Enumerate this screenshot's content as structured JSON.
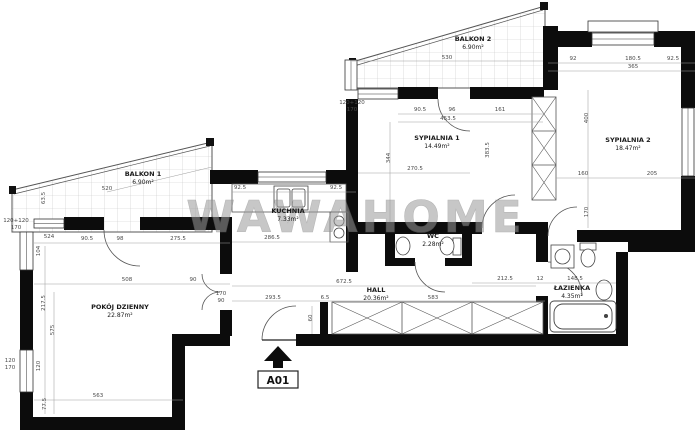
{
  "watermark": "WAWAHOME",
  "entrance": {
    "label": "A01"
  },
  "rooms": [
    {
      "id": "balkon-1",
      "name": "BALKON 1",
      "area": "6.90m²",
      "x": 143,
      "y": 176
    },
    {
      "id": "balkon-2",
      "name": "BALKON 2",
      "area": "6.90m²",
      "x": 473,
      "y": 41
    },
    {
      "id": "sypialnia-1",
      "name": "SYPIALNIA 1",
      "area": "14.49m²",
      "x": 437,
      "y": 140
    },
    {
      "id": "sypialnia-2",
      "name": "SYPIALNIA 2",
      "area": "18.47m²",
      "x": 628,
      "y": 142
    },
    {
      "id": "kuchnia",
      "name": "KUCHNIA",
      "area": "7.33m²",
      "x": 288,
      "y": 213
    },
    {
      "id": "wc",
      "name": "WC",
      "area": "2.28m²",
      "x": 433,
      "y": 238
    },
    {
      "id": "hall",
      "name": "HALL",
      "area": "20.36m²",
      "x": 376,
      "y": 292
    },
    {
      "id": "lazienka",
      "name": "ŁAZIENKA",
      "area": "4.35m²",
      "x": 572,
      "y": 290
    },
    {
      "id": "pokoj-dzienny",
      "name": "POKÓJ DZIENNY",
      "area": "22.87m²",
      "x": 120,
      "y": 309
    }
  ],
  "dimensions": [
    {
      "text": "520",
      "x": 107,
      "y": 190
    },
    {
      "text": "63.5",
      "x": 45,
      "y": 198,
      "rot": true
    },
    {
      "text": "524",
      "x": 49,
      "y": 238
    },
    {
      "text": "104",
      "x": 40,
      "y": 251,
      "rot": true
    },
    {
      "text": "90.5",
      "x": 87,
      "y": 240
    },
    {
      "text": "98",
      "x": 120,
      "y": 240
    },
    {
      "text": "275.5",
      "x": 178,
      "y": 240
    },
    {
      "text": "508",
      "x": 127,
      "y": 281
    },
    {
      "text": "90",
      "x": 193,
      "y": 281
    },
    {
      "text": "217.5",
      "x": 45,
      "y": 303,
      "rot": true
    },
    {
      "text": "575",
      "x": 54,
      "y": 330,
      "rot": true
    },
    {
      "text": "120",
      "x": 40,
      "y": 366,
      "rot": true
    },
    {
      "text": "563",
      "x": 98,
      "y": 397
    },
    {
      "text": "77.5",
      "x": 46,
      "y": 404,
      "rot": true
    },
    {
      "text": "120+120",
      "x": 16,
      "y": 222
    },
    {
      "text": "170",
      "x": 16,
      "y": 229
    },
    {
      "text": "120",
      "x": 10,
      "y": 362
    },
    {
      "text": "170",
      "x": 10,
      "y": 369
    },
    {
      "text": "92.5",
      "x": 240,
      "y": 189
    },
    {
      "text": "92.5",
      "x": 336,
      "y": 189
    },
    {
      "text": "286.5",
      "x": 272,
      "y": 239
    },
    {
      "text": "90.5",
      "x": 420,
      "y": 111
    },
    {
      "text": "96",
      "x": 452,
      "y": 111
    },
    {
      "text": "161",
      "x": 500,
      "y": 111
    },
    {
      "text": "453.5",
      "x": 448,
      "y": 120
    },
    {
      "text": "344",
      "x": 390,
      "y": 158,
      "rot": true
    },
    {
      "text": "270.5",
      "x": 415,
      "y": 170
    },
    {
      "text": "383.5",
      "x": 489,
      "y": 150,
      "rot": true
    },
    {
      "text": "120+120",
      "x": 352,
      "y": 104
    },
    {
      "text": "170",
      "x": 352,
      "y": 111
    },
    {
      "text": "530",
      "x": 447,
      "y": 59
    },
    {
      "text": "92",
      "x": 573,
      "y": 60
    },
    {
      "text": "180.5",
      "x": 633,
      "y": 60
    },
    {
      "text": "92.5",
      "x": 673,
      "y": 60
    },
    {
      "text": "365",
      "x": 633,
      "y": 68
    },
    {
      "text": "400",
      "x": 588,
      "y": 118,
      "rot": true
    },
    {
      "text": "160",
      "x": 583,
      "y": 175
    },
    {
      "text": "205",
      "x": 652,
      "y": 175
    },
    {
      "text": "170",
      "x": 588,
      "y": 212,
      "rot": true
    },
    {
      "text": "672.5",
      "x": 344,
      "y": 283
    },
    {
      "text": "583",
      "x": 433,
      "y": 299
    },
    {
      "text": "293.5",
      "x": 273,
      "y": 299
    },
    {
      "text": "6.5",
      "x": 325,
      "y": 299
    },
    {
      "text": "60",
      "x": 312,
      "y": 318,
      "rot": true
    },
    {
      "text": "170",
      "x": 221,
      "y": 295
    },
    {
      "text": "90",
      "x": 221,
      "y": 302
    },
    {
      "text": "212.5",
      "x": 505,
      "y": 280
    },
    {
      "text": "12",
      "x": 540,
      "y": 280
    },
    {
      "text": "148.5",
      "x": 575,
      "y": 280
    }
  ]
}
